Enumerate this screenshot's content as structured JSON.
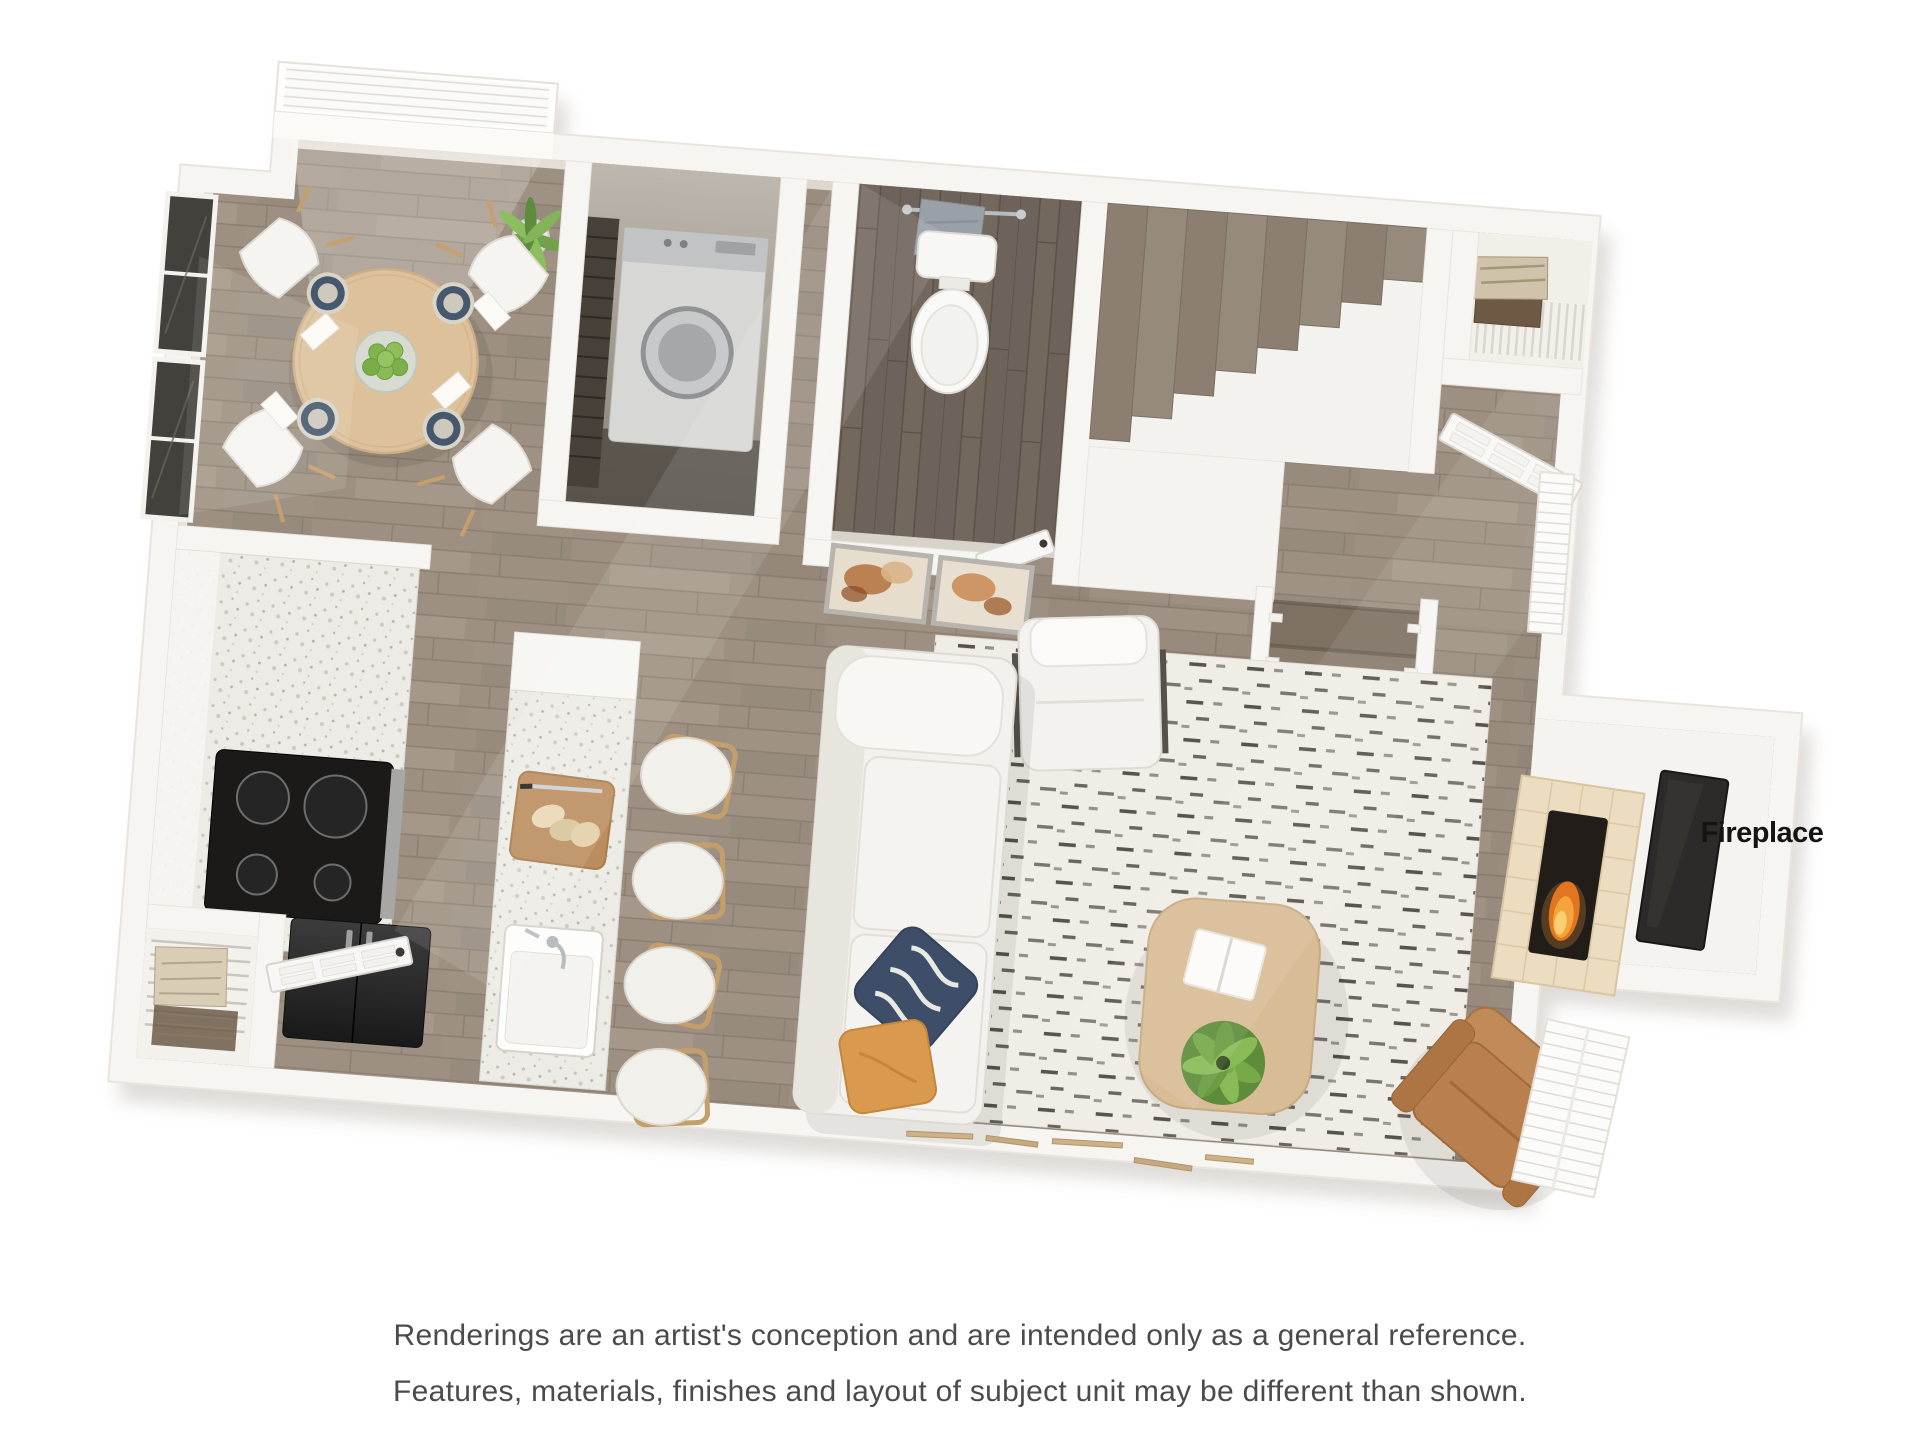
{
  "floorplan": {
    "label_fireplace": "Fireplace",
    "colors": {
      "background": "#ffffff",
      "wall": "#f7f5f1",
      "wall_edge": "#e9e5de",
      "wall_shadow": "#9b9287",
      "floor_wood": "#9d9082",
      "floor_wood_dark": "#6e635a",
      "counter_terrazzo": "#edebe5",
      "cooktop_black": "#1b1a19",
      "fridge_dark": "#2c2c2c",
      "washer_gray": "#d7d7d5",
      "sofa_white": "#f3f1ed",
      "rug_cream": "#f0ede6",
      "rug_dash_black": "#33302b",
      "table_wood": "#d8bc95",
      "dining_table_wood": "#ddc19b",
      "leather_tan": "#b97f4e",
      "pillow_navy": "#3e4e68",
      "pillow_orange": "#d99a4f",
      "plant_green": "#76a94a",
      "apples_green": "#82b44e",
      "flame_orange": "#f5a33c",
      "tile_hearth": "#ecdcc0",
      "tv_dark": "#2d2b29",
      "label_text": "#141414",
      "disclaimer_text": "#4b4b4b"
    }
  },
  "disclaimer": {
    "line1": "Renderings are an artist's conception and are intended only as a general reference.",
    "line2": "Features, materials, finishes and layout of subject unit may be different than shown."
  }
}
